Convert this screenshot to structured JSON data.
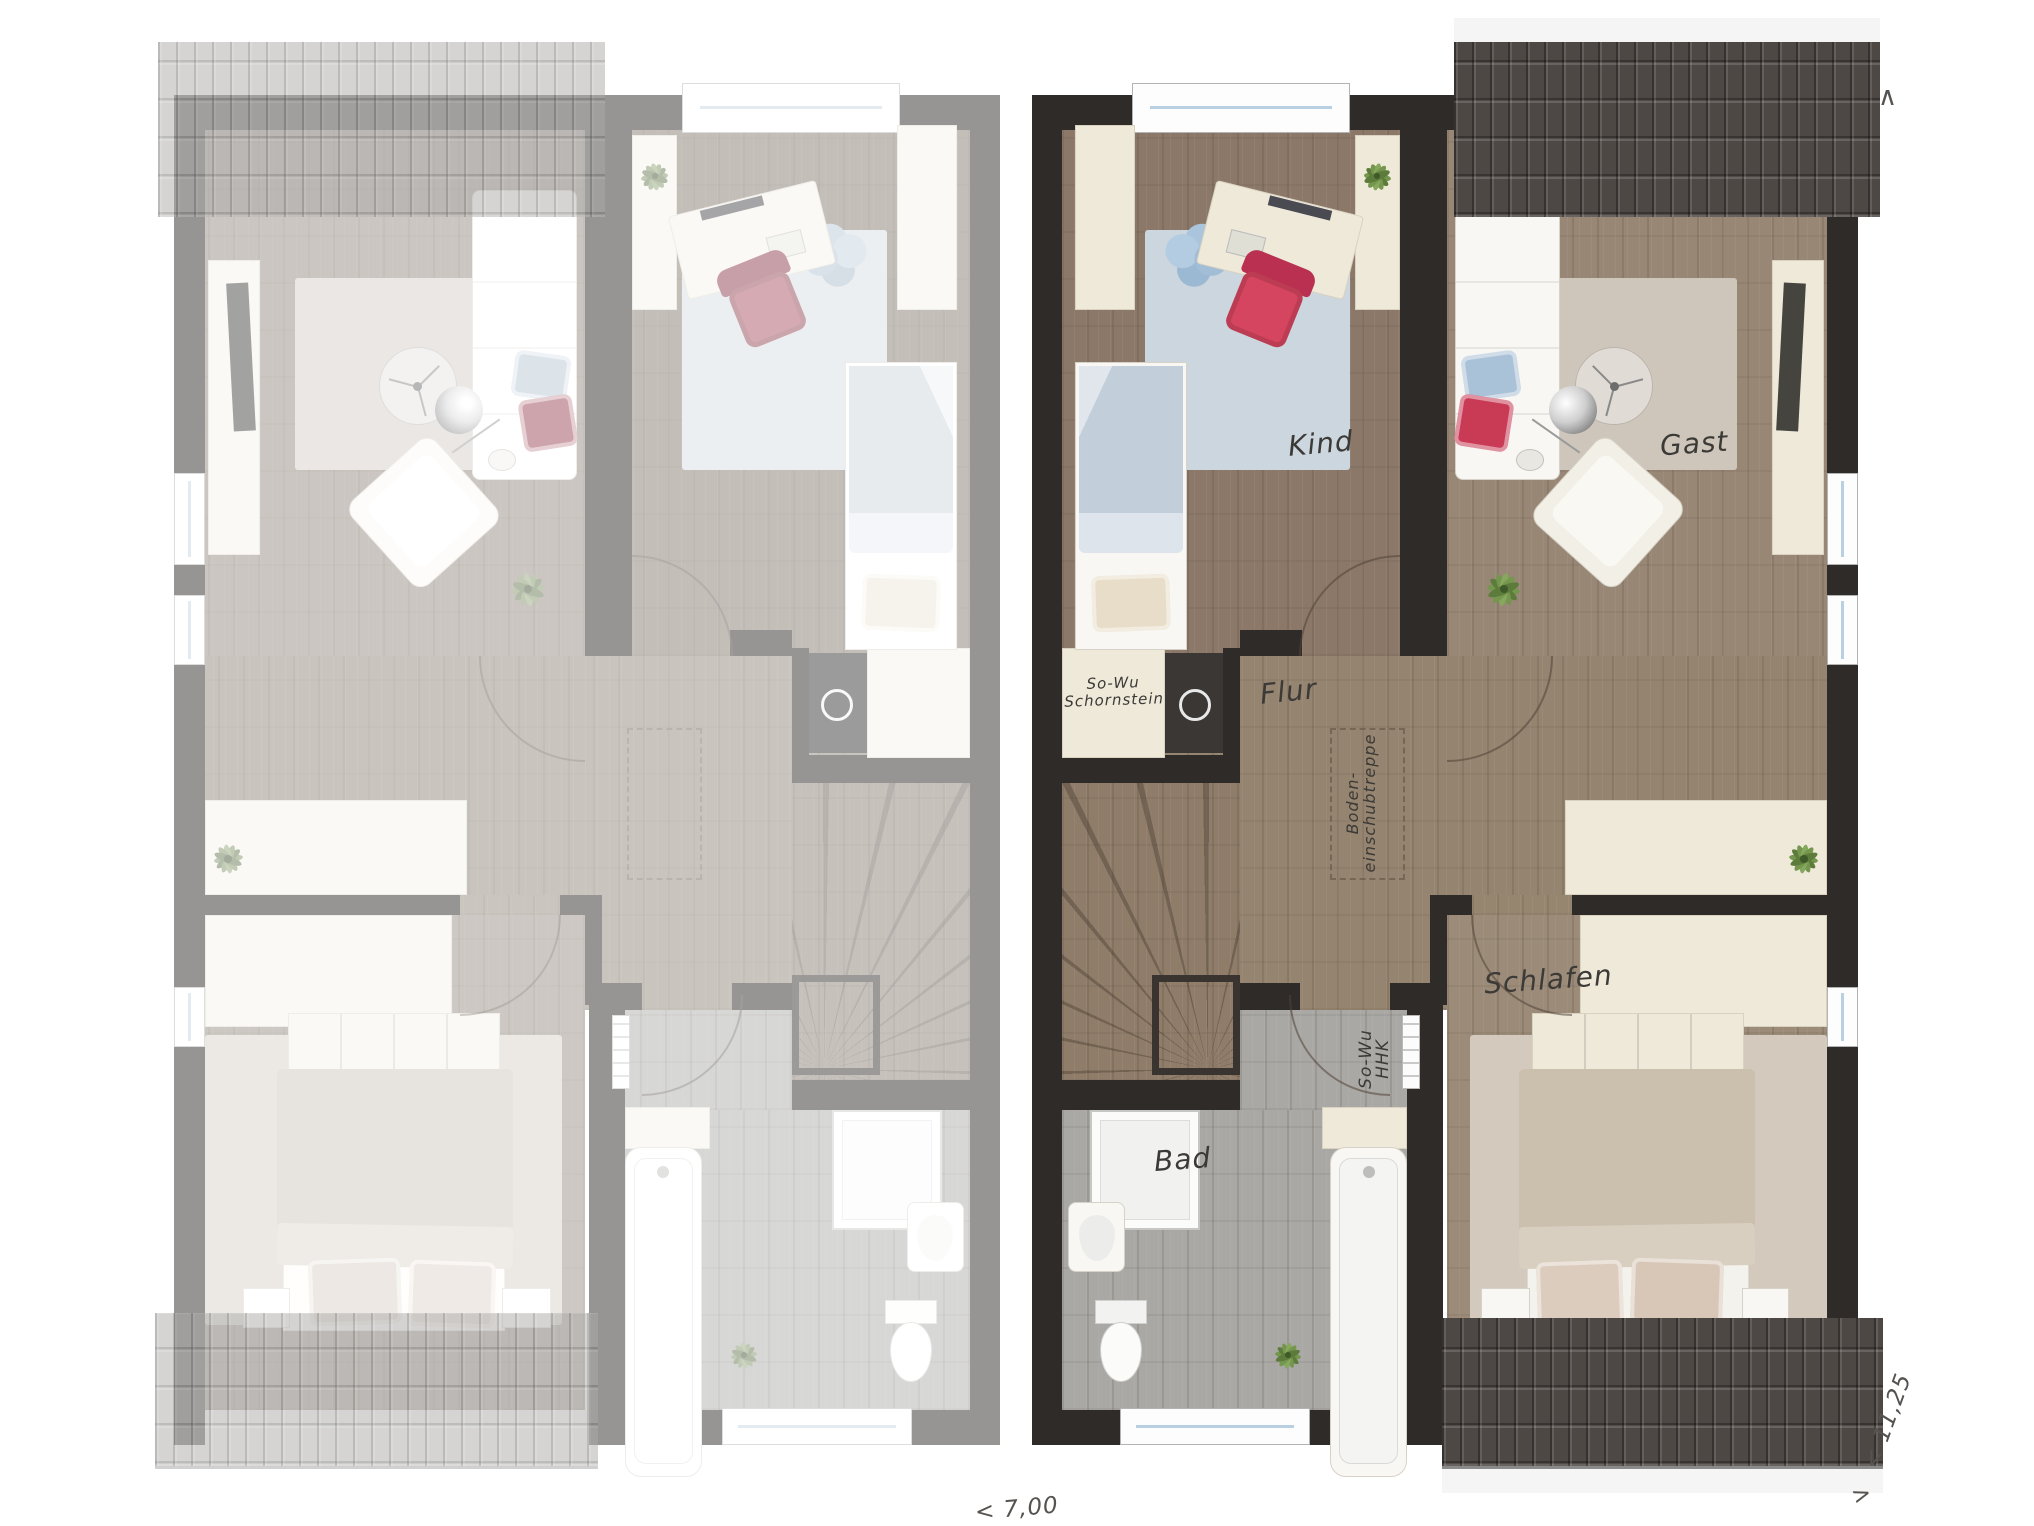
{
  "rooms": {
    "kind": "Kind",
    "gast": "Gast",
    "flur": "Flur",
    "schlafen": "Schlafen",
    "bad": "Bad"
  },
  "annotations": {
    "chimney": {
      "line1": "So-Wu",
      "line2": "Schornstein"
    },
    "attic_stairs": {
      "line1": "Boden-",
      "line2": "einschubtreppe"
    },
    "towel_radiator": {
      "line1": "So-Wu",
      "line2": "HHK"
    }
  },
  "dimensions": {
    "width_label": "< 7,00",
    "depth_label": "< 11,25",
    "arrow_up": "∧",
    "arrow_right": ">"
  },
  "colors": {
    "wall": "#2e2b28",
    "roof_dark": "#4d4844",
    "roof_light": "#a5a29e",
    "floor_wood": "#93826f",
    "floor_bath": "#a9a8a4",
    "rug_child": "#ccd6de",
    "rug_guest": "#cfc6bb",
    "rug_bedroom": "#d3cabd",
    "accent_chair": "#d6455f"
  }
}
